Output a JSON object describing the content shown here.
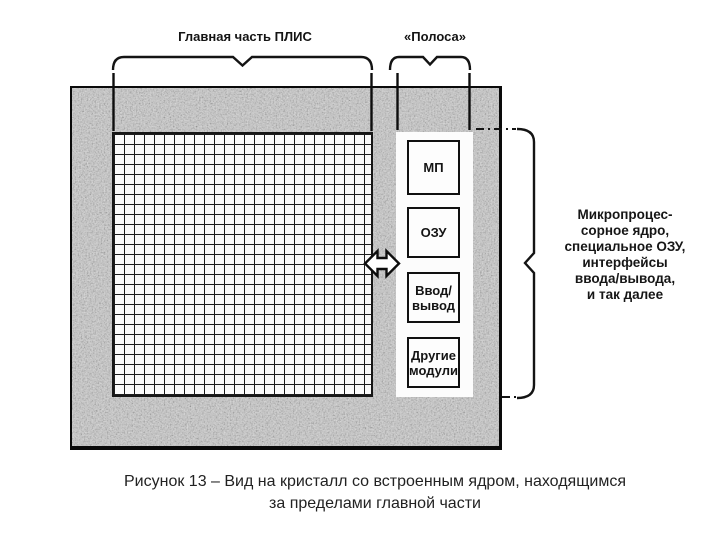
{
  "figure": {
    "labels": {
      "main_part": "Главная часть ПЛИС",
      "strip": "«Полоса»"
    },
    "modules": [
      "МП",
      "ОЗУ",
      "Ввод/\nвывод",
      "Другие\nмодули"
    ],
    "side_note": "Микропроцес-\nсорное ядро,\nспециальное ОЗУ,\nинтерфейсы\nввода/вывода,\nи так далее",
    "caption": "Рисунок 13 – Вид на кристалл со встроенным ядром, находящимся\nза пределами главной части",
    "icons": {
      "bidirectional_arrow": "left-right double-headed arrow linking FPGA fabric and embedded-core strip"
    },
    "colors": {
      "ink": "#121212",
      "die_speckle": "#8c8c8c",
      "background": "#ffffff"
    }
  }
}
